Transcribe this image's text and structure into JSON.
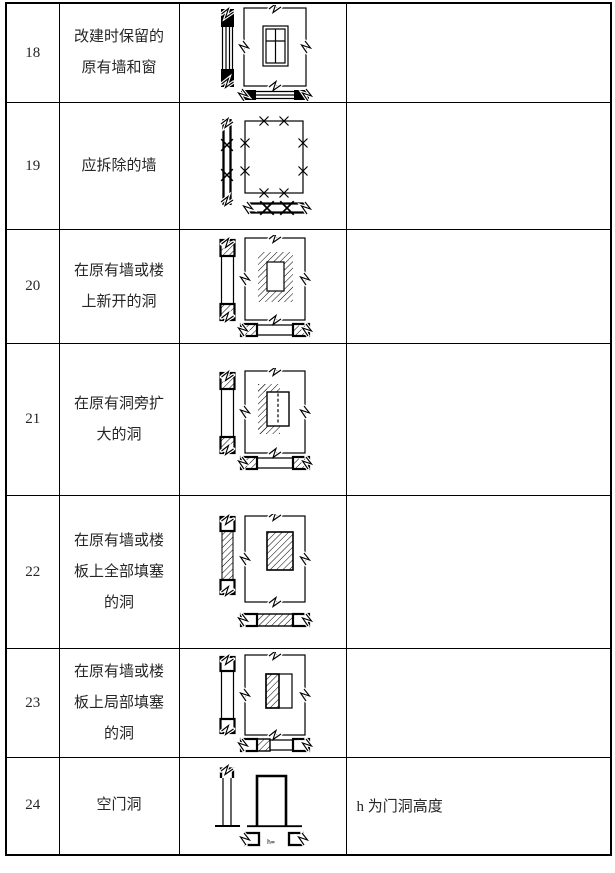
{
  "table": {
    "rows": [
      {
        "no": "18",
        "name": "改建时保留的\n原有墙和窗",
        "note": "",
        "diagram": "retained-wall-and-window"
      },
      {
        "no": "19",
        "name": "应拆除的墙",
        "note": "",
        "diagram": "wall-to-be-demolished"
      },
      {
        "no": "20",
        "name": "在原有墙或楼\n上新开的洞",
        "note": "",
        "diagram": "new-opening-in-existing-wall-or-floor"
      },
      {
        "no": "21",
        "name": "在原有洞旁扩\n大的洞",
        "note": "",
        "diagram": "opening-enlarged-beside-existing-opening"
      },
      {
        "no": "22",
        "name": "在原有墙或楼\n板上全部填塞\n的洞",
        "note": "",
        "diagram": "opening-fully-infilled"
      },
      {
        "no": "23",
        "name": "在原有墙或楼\n板上局部填塞\n的洞",
        "note": "",
        "diagram": "opening-partially-infilled"
      },
      {
        "no": "24",
        "name": "空门洞",
        "note": "h 为门洞高度",
        "diagram": "empty-door-opening",
        "diagram_label": "h="
      }
    ]
  }
}
